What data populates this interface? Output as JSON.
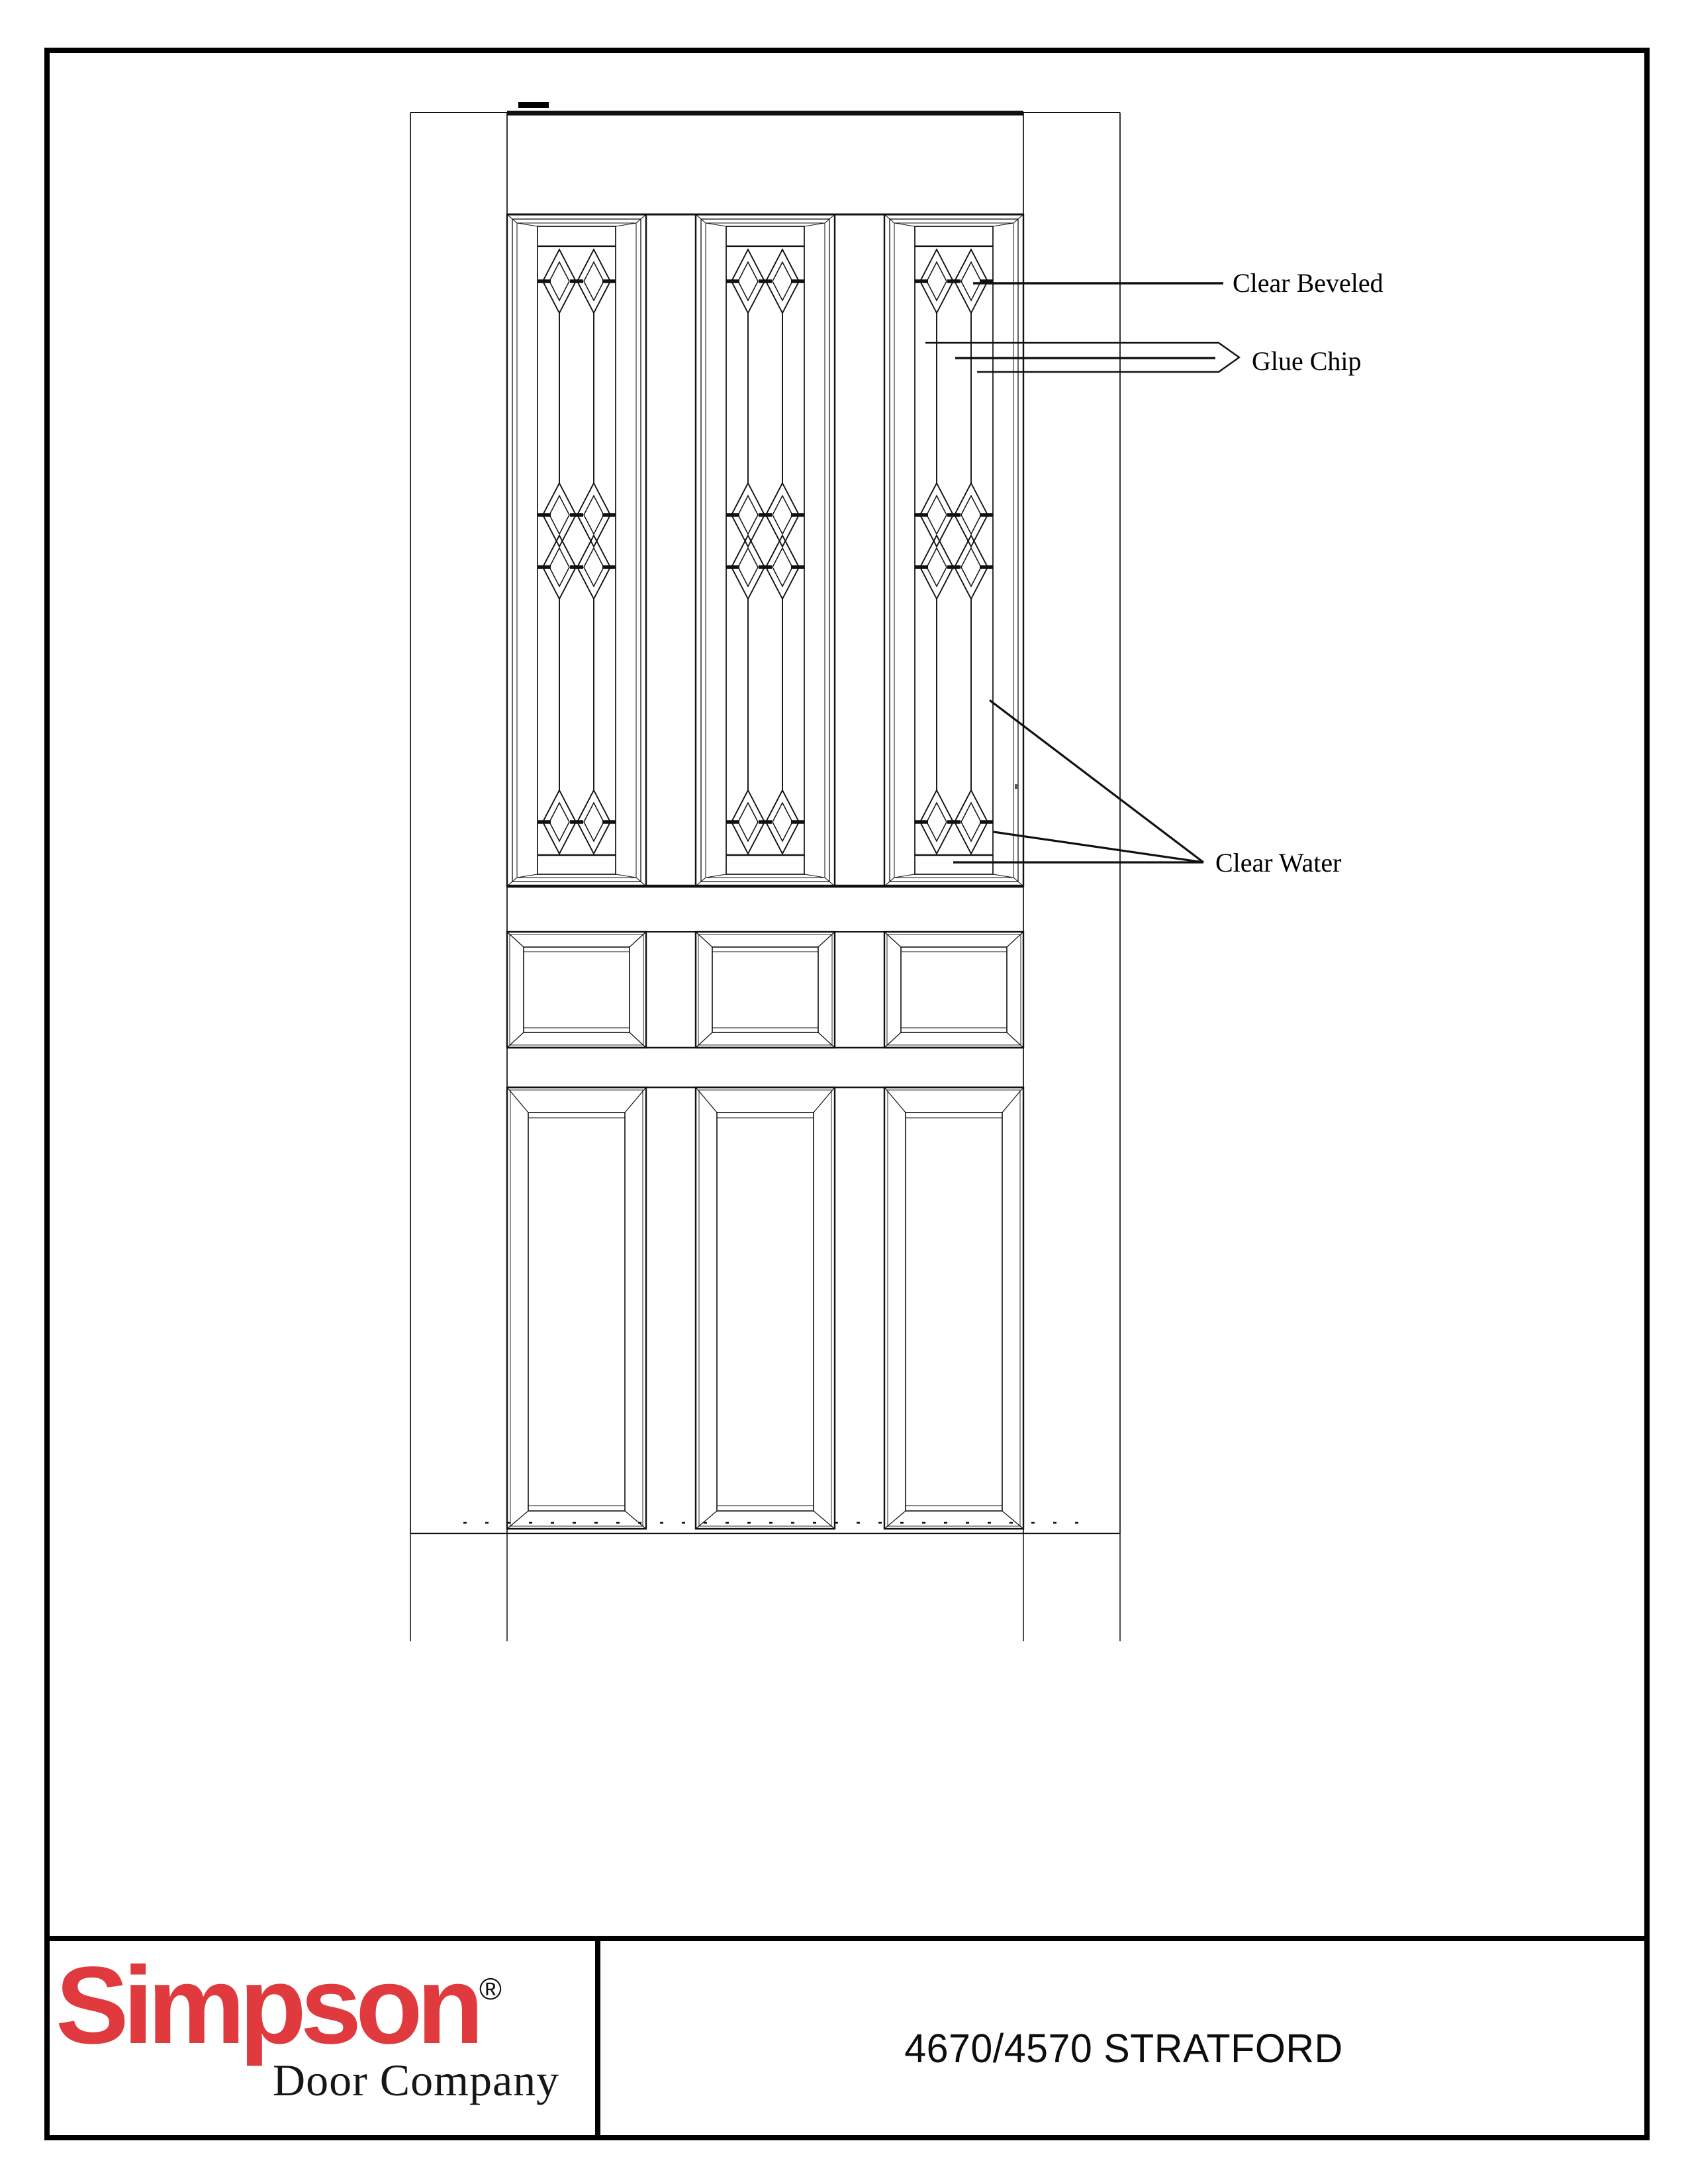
{
  "drawing": {
    "labels": {
      "clear_beveled": "Clear Beveled",
      "glue_chip": "Glue Chip",
      "clear_water": "Clear Water"
    }
  },
  "title_block": {
    "brand": "Simpson",
    "registered_mark": "®",
    "brand_sub": "Door Company",
    "model": "4670/4570 STRATFORD"
  },
  "colors": {
    "line": "#111111",
    "logo_red": "#e03a3e",
    "text": "#161616"
  }
}
